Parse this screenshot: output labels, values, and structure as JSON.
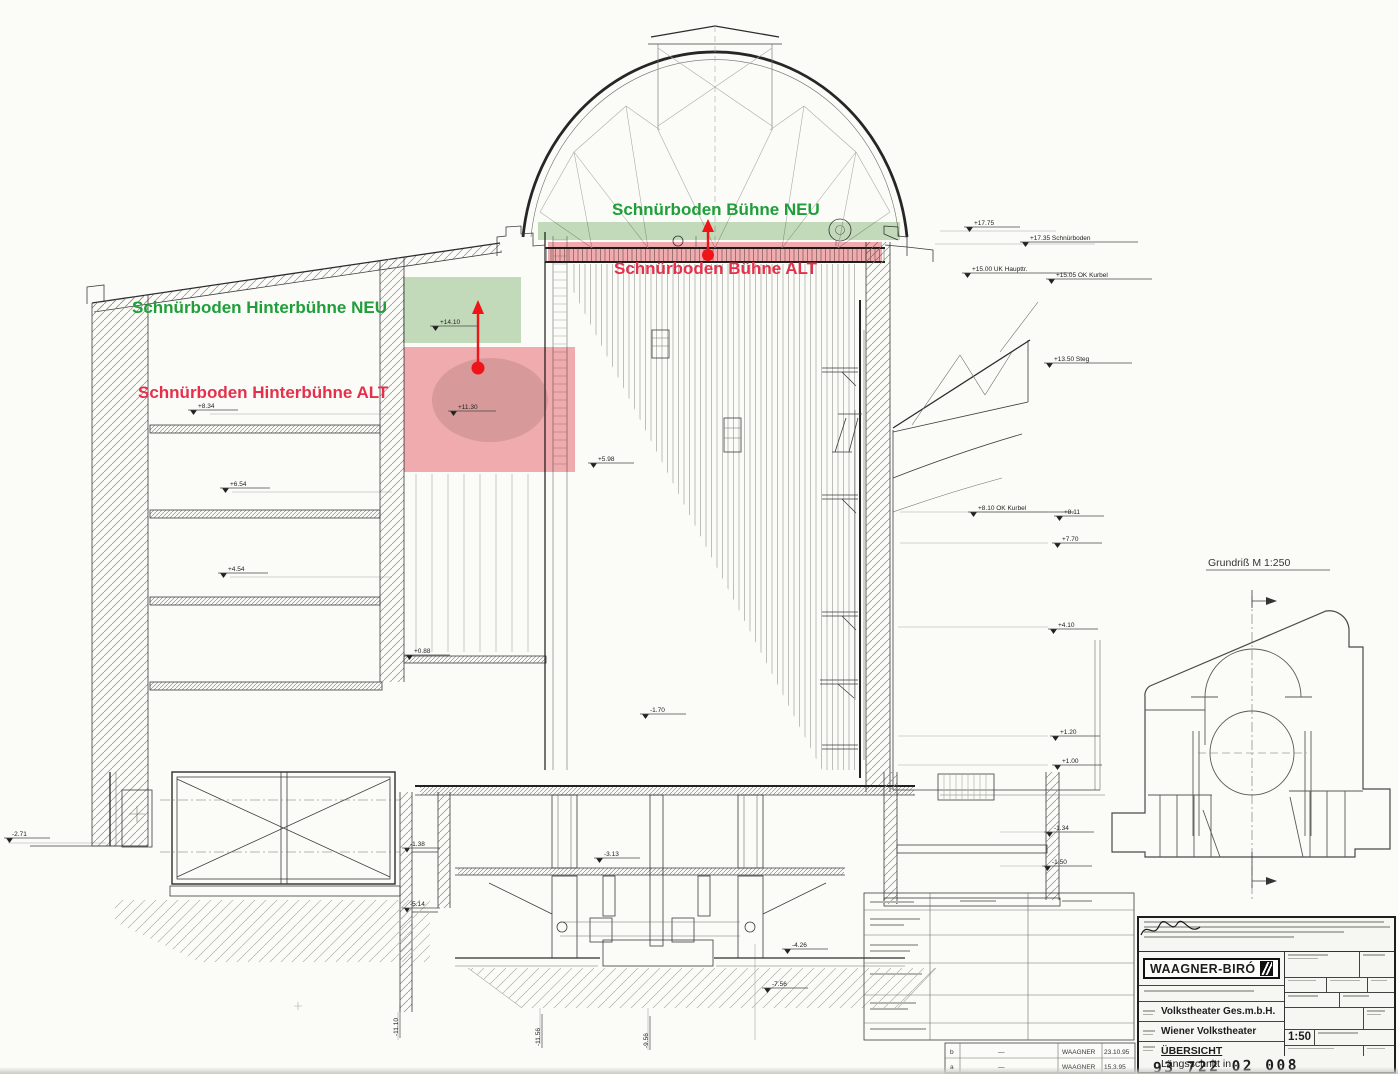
{
  "labels": {
    "buehne_neu": "Schnürboden Bühne NEU",
    "buehne_alt": "Schnürboden Bühne ALT",
    "hinterbuehne_neu": "Schnürboden Hinterbühne NEU",
    "hinterbuehne_alt": "Schnürboden Hinterbühne ALT"
  },
  "colors": {
    "neu_text": "#1f9e3a",
    "alt_text": "#e6304b",
    "neu_fill": "#b7d6ae",
    "alt_fill": "#ef9398",
    "arrow": "#ee1418"
  },
  "markers": [
    {
      "t": "+17.75"
    },
    {
      "t": "+17.35 Schnürboden"
    },
    {
      "t": "+15.00 UK Haupttr."
    },
    {
      "t": "+15.05 OK Kurbel"
    },
    {
      "t": "+13.50 Steg"
    },
    {
      "t": "+8.10 OK Kurbel"
    },
    {
      "t": "+8.11"
    },
    {
      "t": "+7.70"
    },
    {
      "t": "+4.10"
    },
    {
      "t": "+1.20"
    },
    {
      "t": "+1.00"
    },
    {
      "t": "-1.34"
    },
    {
      "t": "-1.50"
    },
    {
      "t": "+8.34"
    },
    {
      "t": "+6.54"
    },
    {
      "t": "+4.54"
    },
    {
      "t": "-2.71"
    },
    {
      "t": "+14.10"
    },
    {
      "t": "+11.30"
    },
    {
      "t": "+5.98"
    },
    {
      "t": "+0.88"
    },
    {
      "t": "-1.70"
    },
    {
      "t": "-3.13"
    },
    {
      "t": "-4.26"
    },
    {
      "t": "-7.56"
    },
    {
      "t": "-1.38"
    },
    {
      "t": "-5.14"
    },
    {
      "t": "-11.10"
    },
    {
      "t": "-11.56"
    },
    {
      "t": "-9.56"
    }
  ],
  "plan": {
    "caption": "Grundriß  M 1:250"
  },
  "titleblock": {
    "company": "WAAGNER-BIRÓ",
    "client": "Volkstheater Ges.m.b.H.",
    "project": "Wiener Volkstheater",
    "doc_title": "ÜBERSICHT",
    "doc_sub1": "Längsschnitt in",
    "doc_sub2": "Theaterachse",
    "scale": "1:50",
    "drawing_no": "93 722 02 008",
    "revisions": [
      {
        "rev": "b",
        "note": "—",
        "by": "WAAGNER",
        "date": "23.10.95"
      },
      {
        "rev": "a",
        "note": "—",
        "by": "WAAGNER",
        "date": "15.3.95"
      }
    ]
  }
}
